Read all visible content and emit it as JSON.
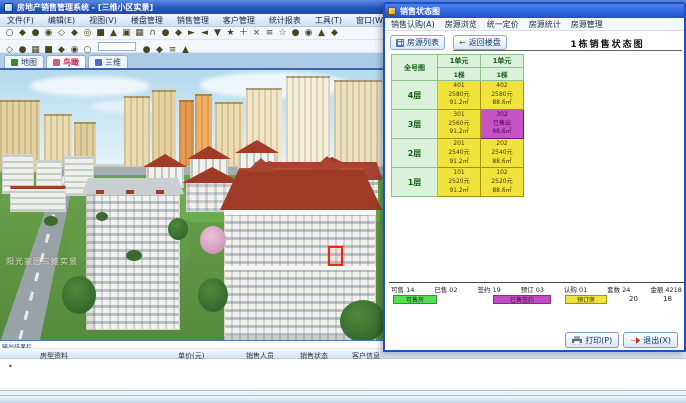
{
  "main_window": {
    "title": "房地产销售管理系统 - [三维小区实景]",
    "menu_items": [
      "文件(F)",
      "编辑(E)",
      "视图(V)",
      "楼盘管理",
      "销售管理",
      "客户管理",
      "统计报表",
      "工具(T)",
      "窗口(W)",
      "帮助(H)"
    ],
    "toolbar_icons_row1": [
      "○",
      "◆",
      "●",
      "◉",
      "◇",
      "◆",
      "◎",
      "■",
      "▲",
      "▣",
      "▦",
      "∩",
      "●",
      "◆",
      "►",
      "◄",
      "▼",
      "★",
      "＋",
      "×",
      "≡",
      "☆",
      "●",
      "◉",
      "▲",
      "◆"
    ],
    "toolbar_icons_row2": [
      "◇",
      "●",
      "▦",
      "■",
      "◆",
      "◉",
      "○"
    ],
    "toolbar_icons_row2b": [
      "●",
      "◆",
      "≡",
      "▲"
    ],
    "view_tabs": [
      "地图",
      "鸟瞰",
      "三维"
    ],
    "viewport": {
      "watermark": "阳光家园三维实景"
    },
    "dock": {
      "label": "输出结果栏",
      "columns": [
        "房型资料",
        "单价(元)",
        "销售人员",
        "销售状态",
        "客户信息"
      ],
      "row_marker": "•"
    }
  },
  "dialog": {
    "title": "销售状态图",
    "menu_items": [
      "销售认购(A)",
      "房源浏览",
      "统一定价",
      "房源统计",
      "房源管理"
    ],
    "toolbar": {
      "list_button": "房源列表",
      "back_button": "返回楼盘"
    },
    "heading": "1栋销售状态图",
    "table": {
      "corner": "全号图",
      "units": [
        "1单元",
        "1单元"
      ],
      "stairs": [
        "1梯",
        "1梯"
      ],
      "rows": [
        {
          "floor": "4层",
          "cells": [
            {
              "lines": [
                "401",
                "2580元",
                "91.2㎡"
              ],
              "status": "available"
            },
            {
              "lines": [
                "402",
                "2580元",
                "88.6㎡"
              ],
              "status": "available"
            }
          ]
        },
        {
          "floor": "3层",
          "cells": [
            {
              "lines": [
                "301",
                "2560元",
                "91.2㎡"
              ],
              "status": "available"
            },
            {
              "lines": [
                "302",
                "已售出",
                "88.6㎡"
              ],
              "status": "sold"
            }
          ]
        },
        {
          "floor": "2层",
          "cells": [
            {
              "lines": [
                "201",
                "2540元",
                "91.2㎡"
              ],
              "status": "available"
            },
            {
              "lines": [
                "202",
                "2540元",
                "88.6㎡"
              ],
              "status": "available"
            }
          ]
        },
        {
          "floor": "1层",
          "cells": [
            {
              "lines": [
                "101",
                "2520元",
                "91.2㎡"
              ],
              "status": "available"
            },
            {
              "lines": [
                "102",
                "2520元",
                "88.6㎡"
              ],
              "status": "available"
            }
          ]
        }
      ]
    },
    "legend": {
      "counts": [
        "可售 14",
        "已售 02",
        "签约 19",
        "预订 03",
        "认购 01",
        "套数 24",
        "金额 4218"
      ],
      "swatches": [
        {
          "label": "可售房",
          "color": "#52e052"
        },
        {
          "label": "已售签约",
          "color": "#c24ac2"
        },
        {
          "label": "预订房",
          "color": "#f0e33c"
        }
      ],
      "extras": [
        "20",
        "18"
      ]
    },
    "buttons": {
      "print": "打印(P)",
      "close": "退出(X)"
    }
  },
  "colors": {
    "accent_blue": "#2558c0",
    "available_yellow": "#f0e33c",
    "sold_purple": "#c653c6",
    "header_green": "#d9f2d9",
    "selection_red": "#ee2818"
  }
}
